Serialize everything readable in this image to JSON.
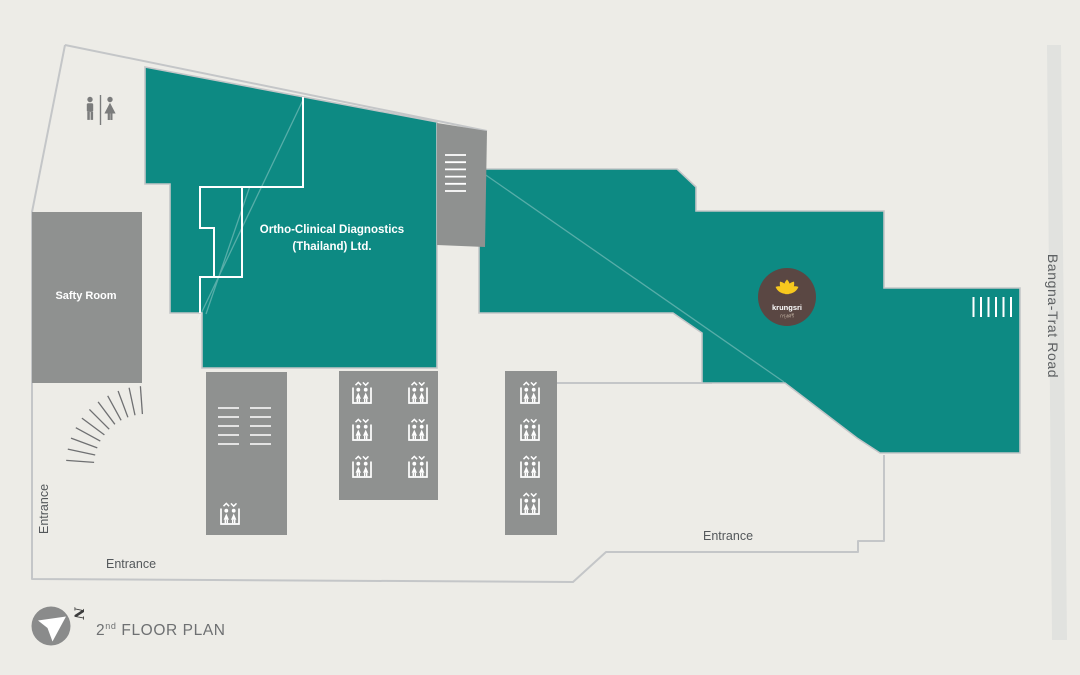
{
  "floor_plan": {
    "title": {
      "number": "2",
      "ordinal": "nd",
      "text": "FLOOR PLAN"
    },
    "road_label": "Bangna-Trat Road",
    "safety_room_label": "Safty Room",
    "tenant_label_line1": "Ortho-Clinical Diagnostics",
    "tenant_label_line2": "(Thailand) Ltd.",
    "entrance_left": "Entrance",
    "entrance_bottom": "Entrance",
    "entrance_right": "Entrance",
    "compass_letter": "N",
    "logo": {
      "brand": "krungsri",
      "brand_thai": "กรุงศรี"
    },
    "colors": {
      "tenant_area": "#0d8a83",
      "service_area": "#8f9190",
      "outline": "#c4c6c8",
      "background": "#edece7",
      "road": "#e1e2df",
      "logo_bg": "#5a4743",
      "logo_lotus": "#f7c81e"
    },
    "icons": {
      "restroom": "restroom-icon",
      "elevator": "elevator-icon",
      "stairs": "stairs-icon",
      "compass": "north-compass-icon",
      "logo": "krungsri-logo"
    }
  }
}
